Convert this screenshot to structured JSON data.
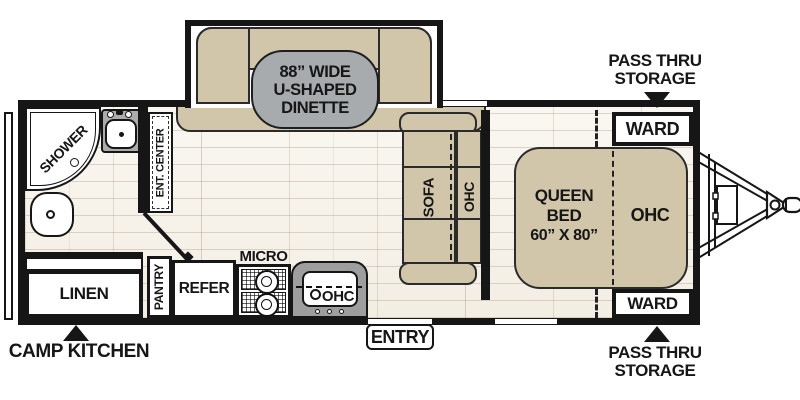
{
  "colors": {
    "wall": "#161616",
    "tan": "#d1c6aa",
    "tan_stroke": "#2b2b2b",
    "blob": "#a7abae",
    "counter_gray": "#9e9e9e",
    "sink_gray": "#acacac",
    "floor_base": "#f6f2ea",
    "text": "#161616"
  },
  "callouts": {
    "pass_thru_top": {
      "line1": "PASS THRU",
      "line2": "STORAGE"
    },
    "pass_thru_bottom": {
      "line1": "PASS THRU",
      "line2": "STORAGE"
    },
    "camp_kitchen": "CAMP KITCHEN",
    "entry": "ENTRY"
  },
  "dinette": {
    "line1": "88” WIDE",
    "line2": "U-SHAPED",
    "line3": "DINETTE"
  },
  "bathroom": {
    "shower": "SHOWER"
  },
  "living": {
    "ent_center": "ENT. CENTER",
    "sofa": "SOFA",
    "ohc": "OHC"
  },
  "kitchen": {
    "linen": "LINEN",
    "pantry": "PANTRY",
    "refer": "REFER",
    "micro": "MICRO",
    "ohc": "OHC"
  },
  "bedroom": {
    "bed_line1": "QUEEN BED",
    "bed_line2": "60” X 80”",
    "ohc": "OHC",
    "ward_top": "WARD",
    "ward_bottom": "WARD"
  }
}
